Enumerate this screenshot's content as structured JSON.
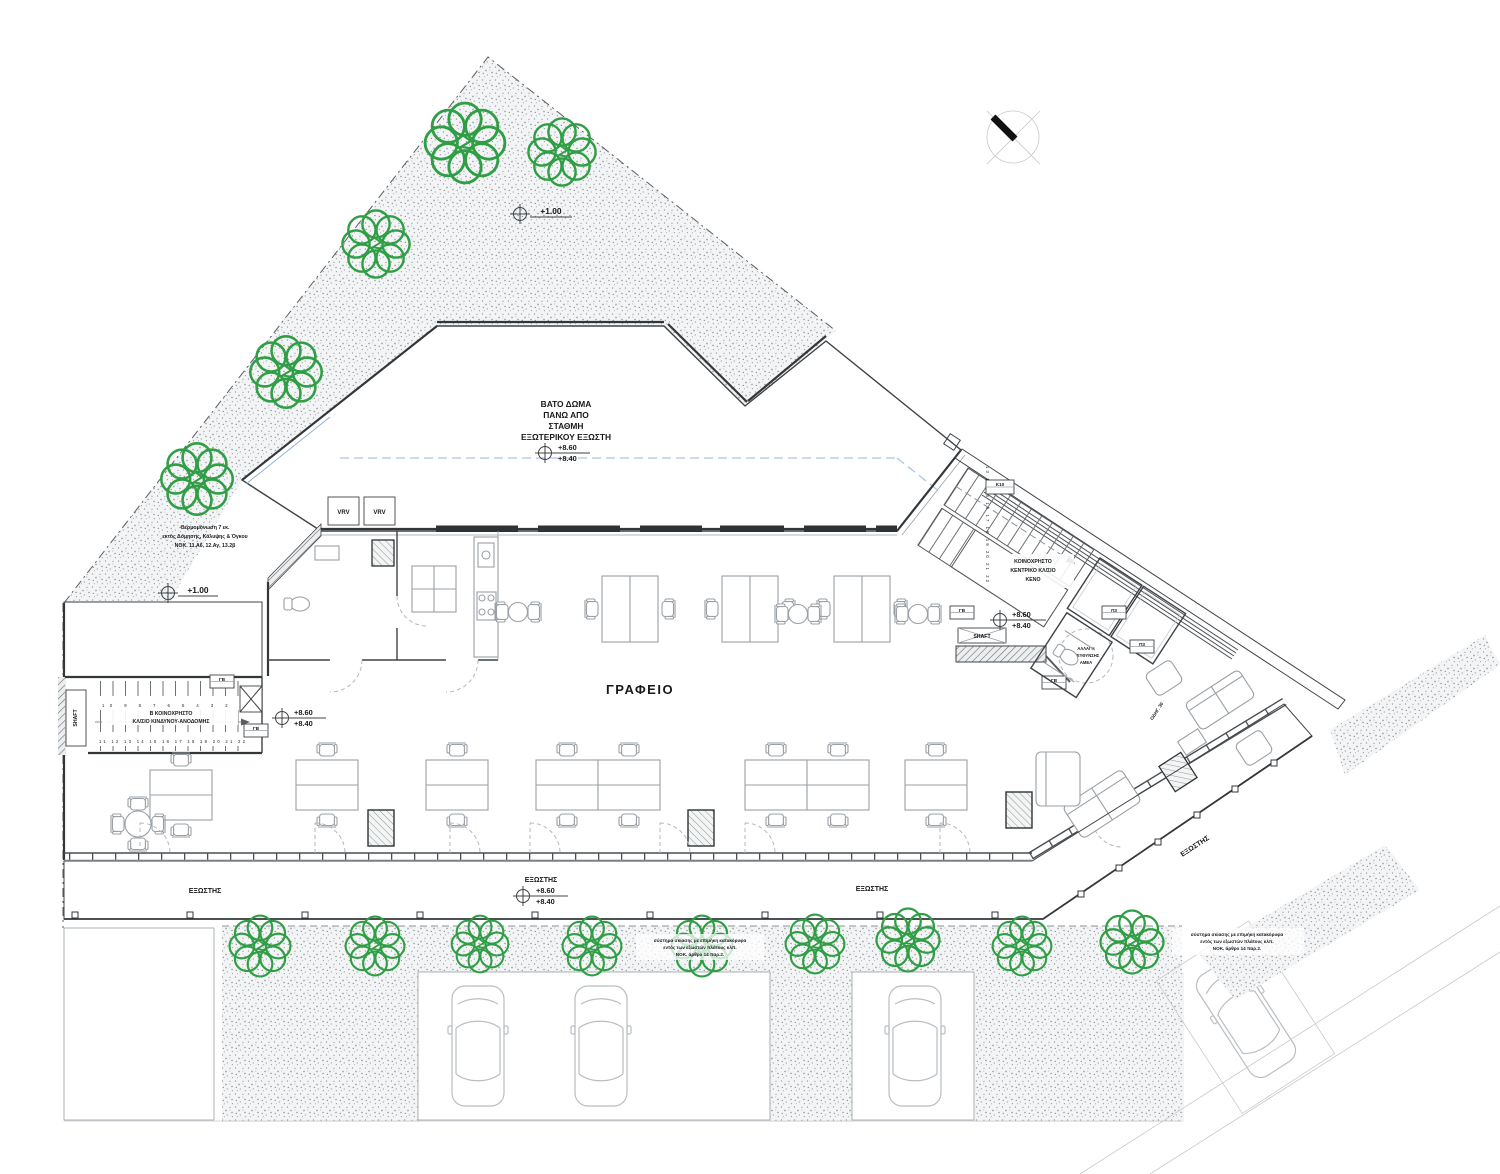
{
  "colors": {
    "tree": "#2f9e44",
    "walls": "#33373a",
    "tile_grid": "#dde1e4",
    "stipple": "#9aa0a4",
    "blue_dashed": "#a9c7e4",
    "window_bar": "#2e3234"
  },
  "plan": {
    "office_label": "ΓΡΑΦΕΙΟ",
    "balcony_label": "ΕΞΩΣΤΗΣ",
    "roof_note": {
      "l1": "ΒΑΤΟ ΔΩΜΑ",
      "l2": "ΠΑΝΩ ΑΠΟ",
      "l3": "ΣΤΑΘΜΗ",
      "l4": "ΕΞΩΤΕΡΙΚΟΥ ΕΞΩΣΤΗ"
    },
    "levels": {
      "upper": "+8.60",
      "lower": "+8.40",
      "ground": "+1.00"
    },
    "stairs_left": {
      "l1": "Β ΚΟΙΝΟΧΡΗΣΤΟ",
      "l2": "ΚΛ/ΣΙΟ ΚΙΝΔΥΝΟΥ-ΑΝΟΔΟΜΗΣ",
      "top_numbers": "10  9  8  7  6  5  4  3  2  1",
      "bottom_numbers": "11 12 13 14 15 16 17 18 19 20 21 22"
    },
    "stairs_right": {
      "l1": "ΚΟΙΝΟΧΡΗΣΤΟ",
      "l2": "ΚΕΝΤΡΙΚΟ ΚΛ/ΣΙΟ",
      "l3": "ΚΕΝΟ",
      "side_numbers": "13 14 15 16 17 18 19 20 21 22"
    },
    "amea": {
      "l1": "ΑΛΛΑΓΗ",
      "l2": "ΔΙΕΥΘΥΝΣΗΣ",
      "l3": "ΑΜΕΑ"
    },
    "tags": {
      "vrv": "VRV",
      "shaft": "SHAFT",
      "gb": "ΓΒ",
      "p3": "Π3",
      "k10": "Κ10",
      "odig": "ΟΔΗΓ. 30"
    },
    "note_site": {
      "l1": "Θερμομόνωση 7 εκ.",
      "l2": "εκτός Δόμησης, Κάλυψης & Όγκου",
      "l3": "ΝΟΚ. 11.Α6, 12.Αγ, 13.2β"
    },
    "note_shading": {
      "l1": "σύστημα σκίασης με επιμήκη κατακόρυφα",
      "l2": "εντός των εξωστών πλάτους κλπ.",
      "l3": "ΝΟΚ. άρθρο 14 παρ.2."
    }
  }
}
